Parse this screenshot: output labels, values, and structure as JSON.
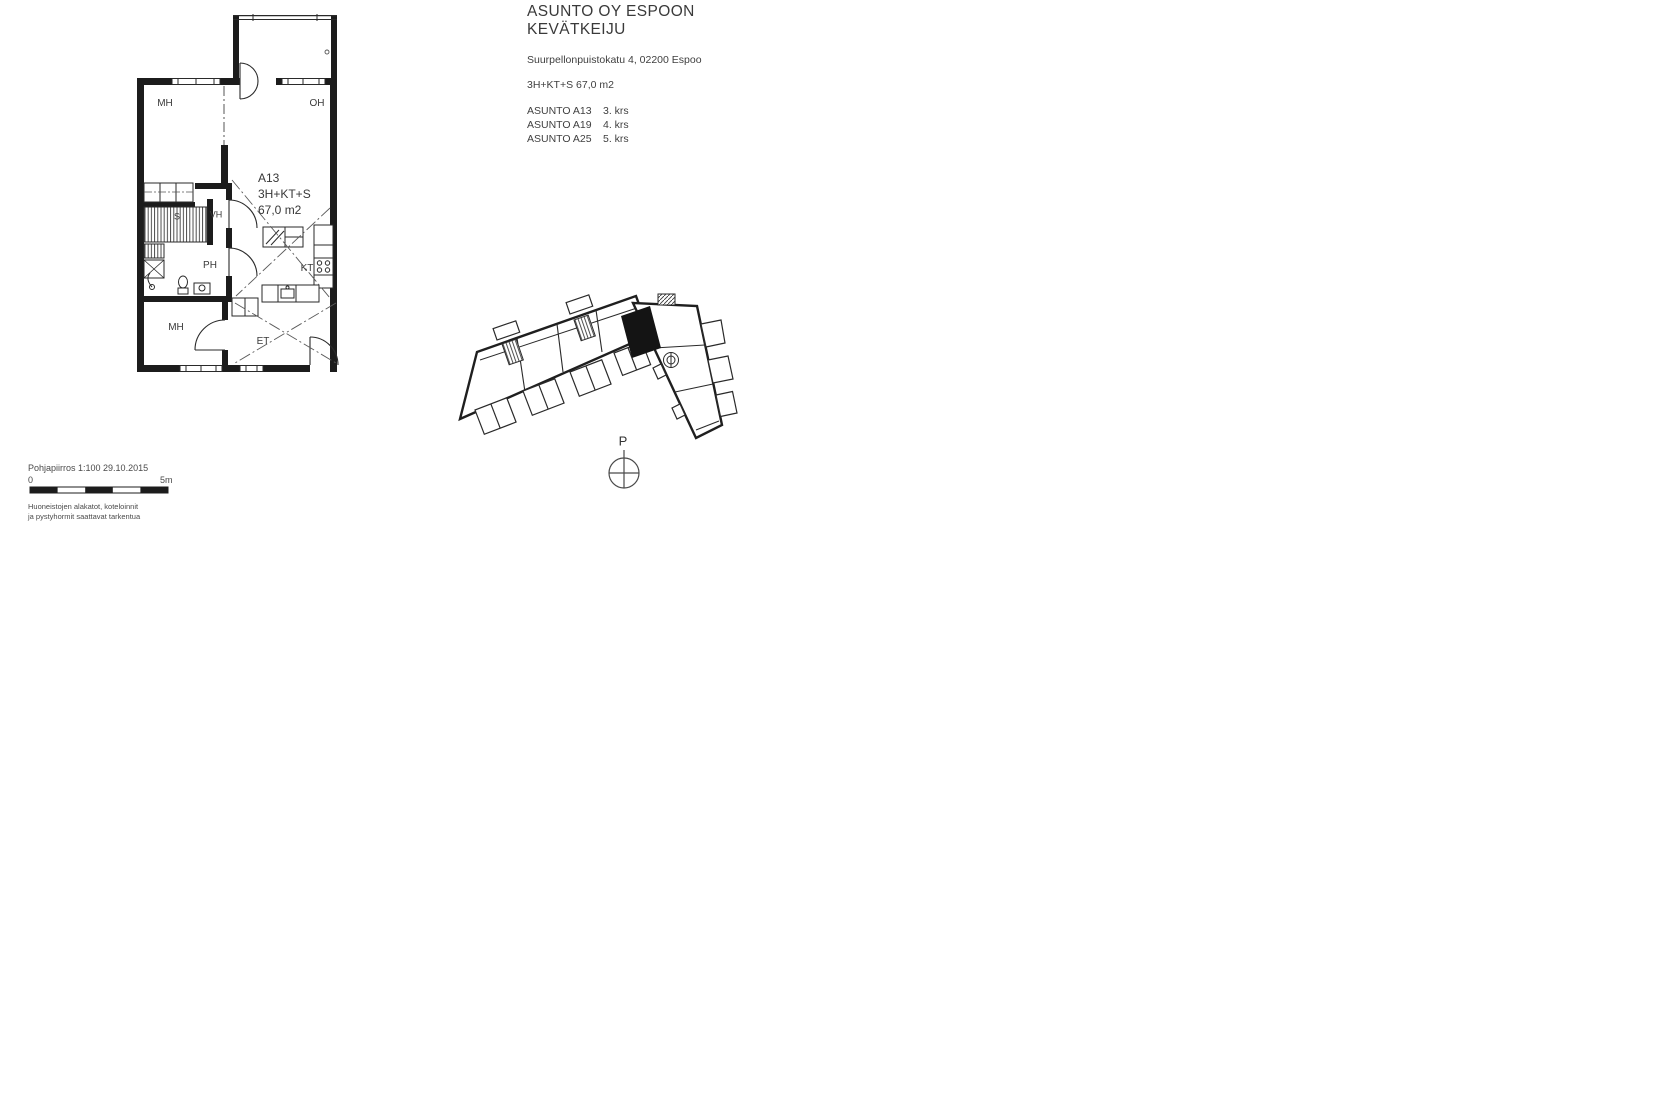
{
  "header": {
    "title_line1": "ASUNTO OY ESPOON",
    "title_line2": "KEVÄTKEIJU",
    "address": "Suurpellonpuistokatu 4, 02200 Espoo",
    "apartment_type": "3H+KT+S 67,0 m2",
    "apartments": [
      {
        "name": "ASUNTO A13",
        "floor": "3. krs"
      },
      {
        "name": "ASUNTO A19",
        "floor": "4. krs"
      },
      {
        "name": "ASUNTO A25",
        "floor": "5. krs"
      }
    ]
  },
  "floor_plan": {
    "annotation": {
      "id": "A13",
      "type": "3H+KT+S",
      "area": "67,0 m2"
    },
    "rooms": {
      "mh_top": "MH",
      "oh": "OH",
      "sauna": "S",
      "vh": "VH",
      "ph": "PH",
      "kt": "KT",
      "mh_bottom": "MH",
      "et": "ET"
    }
  },
  "site_plan": {
    "north_label": "P"
  },
  "scale": {
    "caption": "Pohjapiirros 1:100 29.10.2015",
    "start": "0",
    "end": "5m",
    "note_line1": "Huoneistojen alakatot, koteloinnit",
    "note_line2": "ja pystyhormit saattavat tarkentua"
  },
  "colors": {
    "ink": "#1c1c1c",
    "text": "#3c3c3c",
    "highlight": "#141414"
  }
}
